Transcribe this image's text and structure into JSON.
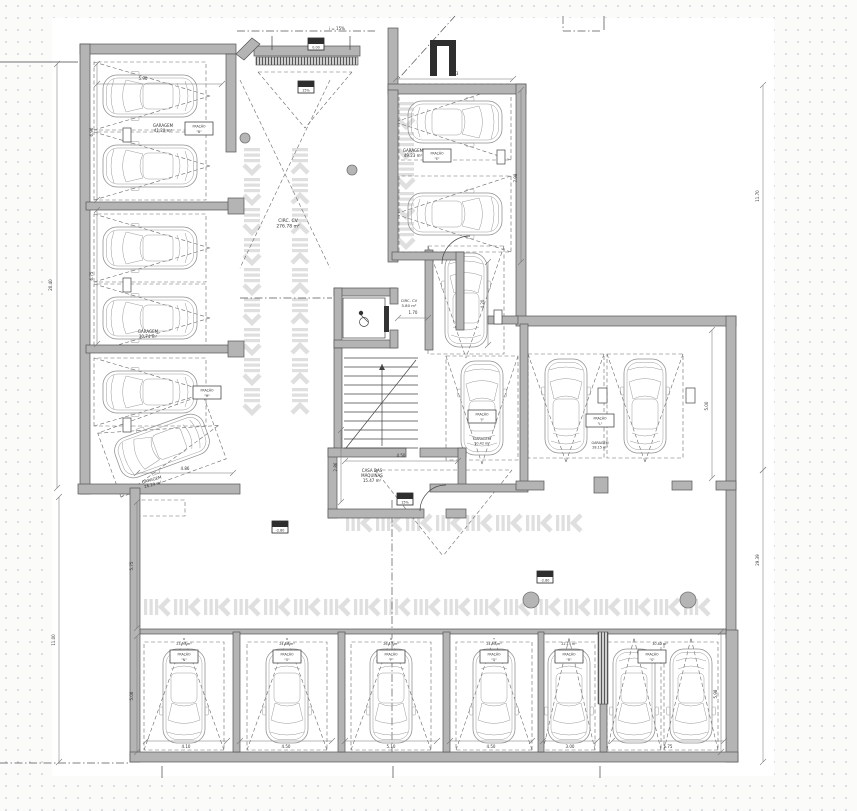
{
  "colors": {
    "paper": "#ffffff",
    "wall": "#b4b4b4",
    "wall_stroke": "#555555",
    "line": "#444444",
    "dash": "#6a6a6a",
    "car": "#8f8f8f",
    "chevron": "#dfdfdf",
    "dark": "#2e2e2e",
    "dot": "#d0d4db"
  },
  "paper": [
    52,
    18,
    722,
    758
  ],
  "labels": [
    {
      "lines": [
        "GARAGEM",
        "41.20 m²"
      ],
      "x": 163,
      "y": 127,
      "s": 4,
      "r": 0
    },
    {
      "lines": [
        "GARAGEM",
        "30.74 m²"
      ],
      "x": 148,
      "y": 333,
      "s": 4,
      "r": 0
    },
    {
      "lines": [
        "GARAGEM",
        "26.29 m²"
      ],
      "x": 152,
      "y": 481,
      "s": 4,
      "r": -15
    },
    {
      "lines": [
        "GARAGEM",
        "49.23 m²"
      ],
      "x": 413,
      "y": 152,
      "s": 4,
      "r": 0
    },
    {
      "lines": [
        "CIRC. CV",
        "276.78 m²"
      ],
      "x": 288,
      "y": 222,
      "s": 4.5,
      "r": 0
    },
    {
      "lines": [
        "CIRC. CV",
        "5.80 m²"
      ],
      "x": 409,
      "y": 302,
      "s": 3.8,
      "r": 0
    },
    {
      "lines": [
        "CASA DAS",
        "MÁQUINAS",
        "15.47 m²"
      ],
      "x": 372,
      "y": 472,
      "s": 4,
      "r": 0
    },
    {
      "lines": [
        "i = 15%"
      ],
      "x": 337,
      "y": 30,
      "s": 4,
      "r": 0
    },
    {
      "lines": [
        "23.95 m²"
      ],
      "x": 184,
      "y": 645,
      "s": 3.4,
      "r": 0
    },
    {
      "lines": [
        "24.86 m²"
      ],
      "x": 287,
      "y": 645,
      "s": 3.4,
      "r": 0
    },
    {
      "lines": [
        "26.15 m²"
      ],
      "x": 391,
      "y": 645,
      "s": 3.4,
      "r": 0
    },
    {
      "lines": [
        "24.90 m²"
      ],
      "x": 494,
      "y": 645,
      "s": 3.4,
      "r": 0
    },
    {
      "lines": [
        "22.15 m²"
      ],
      "x": 569,
      "y": 645,
      "s": 3.4,
      "r": 0
    },
    {
      "lines": [
        "30.82 m²"
      ],
      "x": 660,
      "y": 645,
      "s": 3.4,
      "r": 0
    },
    {
      "lines": [
        "GARAGEM",
        "10.42 m²"
      ],
      "x": 482,
      "y": 440,
      "s": 3.4,
      "r": 0
    },
    {
      "lines": [
        "GARAGEM",
        "28.15 m²"
      ],
      "x": 600,
      "y": 444,
      "s": 3.4,
      "r": 0
    }
  ],
  "fracao_tags": [
    {
      "x": 199,
      "y": 122,
      "t": "FRAÇÃO",
      "l": "\"B\""
    },
    {
      "x": 207,
      "y": 386,
      "t": "FRAÇÃO",
      "l": "\"M\""
    },
    {
      "x": 437,
      "y": 149,
      "t": "FRAÇÃO",
      "l": "\"E\""
    },
    {
      "x": 482,
      "y": 410,
      "t": "FRAÇÃO",
      "l": "\"J\""
    },
    {
      "x": 600,
      "y": 414,
      "t": "FRAÇÃO",
      "l": "\"L\""
    },
    {
      "x": 184,
      "y": 650,
      "t": "FRAÇÃO",
      "l": "\"N\""
    },
    {
      "x": 287,
      "y": 650,
      "t": "FRAÇÃO",
      "l": "\"O\""
    },
    {
      "x": 391,
      "y": 650,
      "t": "FRAÇÃO",
      "l": "\"P\""
    },
    {
      "x": 494,
      "y": 650,
      "t": "FRAÇÃO",
      "l": "\"Q\""
    },
    {
      "x": 569,
      "y": 650,
      "t": "FRAÇÃO",
      "l": "\"R\""
    },
    {
      "x": 652,
      "y": 650,
      "t": "FRAÇÃO",
      "l": "\"S\""
    }
  ],
  "level_markers": [
    {
      "x": 316,
      "y": 44,
      "text": "0.00"
    },
    {
      "x": 306,
      "y": 87,
      "text": "15%"
    },
    {
      "x": 405,
      "y": 499,
      "text": "15%"
    },
    {
      "x": 280,
      "y": 527,
      "text": "-2.80"
    },
    {
      "x": 545,
      "y": 577,
      "text": "-2.80"
    }
  ],
  "dimensions": [
    [
      57,
      64,
      57,
      488,
      "20.40",
      52,
      285,
      -90
    ],
    [
      59,
      497,
      59,
      762,
      "11.00",
      55,
      640,
      -90
    ],
    [
      137,
      502,
      137,
      628,
      "5.75",
      133,
      566,
      -90
    ],
    [
      137,
      636,
      137,
      752,
      "5.06",
      133,
      696,
      -90
    ],
    [
      763,
      85,
      763,
      470,
      "11.70",
      759,
      196,
      -90
    ],
    [
      763,
      470,
      763,
      762,
      "29.39",
      759,
      560,
      -90
    ],
    [
      396,
      79,
      513,
      79,
      "6.33",
      454,
      75,
      0
    ],
    [
      521,
      90,
      521,
      262,
      "7.98",
      517,
      178,
      -90
    ],
    [
      712,
      330,
      712,
      478,
      "5.00",
      708,
      406,
      -90
    ],
    [
      721,
      632,
      721,
      752,
      "5.98",
      717,
      694,
      -90
    ],
    [
      146,
      741,
      227,
      741,
      "4.10",
      186,
      748,
      0
    ],
    [
      240,
      741,
      332,
      741,
      "4.50",
      286,
      748,
      0
    ],
    [
      345,
      741,
      437,
      741,
      "5.10",
      391,
      748,
      0
    ],
    [
      450,
      741,
      532,
      741,
      "4.50",
      491,
      748,
      0
    ],
    [
      543,
      741,
      597,
      741,
      "3.00",
      570,
      748,
      0
    ],
    [
      612,
      741,
      724,
      741,
      "5.75",
      668,
      748,
      0
    ],
    [
      345,
      461,
      458,
      461,
      "4.50",
      401,
      457,
      0
    ],
    [
      341,
      430,
      341,
      502,
      "2.86",
      337,
      467,
      -90
    ],
    [
      137,
      473,
      233,
      473,
      "4.86",
      185,
      470,
      0
    ],
    [
      97,
      64,
      97,
      200,
      "6.96",
      93,
      132,
      -90
    ],
    [
      97,
      210,
      97,
      344,
      "6.75",
      93,
      276,
      -90
    ],
    [
      97,
      84,
      222,
      84,
      "5.90",
      143,
      80,
      0
    ],
    [
      488,
      262,
      488,
      345,
      "4.20",
      484,
      304,
      -90
    ],
    [
      398,
      318,
      428,
      318,
      "1.70",
      413,
      314,
      0
    ]
  ],
  "cars": [
    [
      150,
      96,
      -90,
      34,
      56
    ],
    [
      150,
      166,
      -90,
      34,
      56
    ],
    [
      150,
      248,
      -90,
      34,
      56
    ],
    [
      150,
      318,
      -90,
      34,
      56
    ],
    [
      150,
      392,
      -90,
      34,
      56
    ],
    [
      162,
      446,
      -110,
      34,
      56
    ],
    [
      455,
      122,
      90,
      38,
      56
    ],
    [
      455,
      214,
      90,
      38,
      56
    ],
    [
      466,
      300,
      0,
      38,
      54
    ],
    [
      482,
      408,
      0,
      36,
      52
    ],
    [
      566,
      406,
      0,
      38,
      52
    ],
    [
      645,
      406,
      0,
      38,
      52
    ],
    [
      184,
      696,
      180,
      40,
      54
    ],
    [
      287,
      696,
      180,
      40,
      54
    ],
    [
      391,
      696,
      180,
      40,
      54
    ],
    [
      494,
      696,
      180,
      38,
      54
    ],
    [
      569,
      696,
      180,
      26,
      54
    ],
    [
      634,
      696,
      180,
      27,
      54
    ],
    [
      691,
      696,
      180,
      27,
      54
    ]
  ],
  "walls": [
    [
      80,
      44,
      156,
      10
    ],
    [
      80,
      44,
      10,
      450
    ],
    [
      78,
      484,
      162,
      10
    ],
    [
      226,
      54,
      10,
      98
    ],
    [
      86,
      202,
      146,
      8
    ],
    [
      228,
      198,
      16,
      16
    ],
    [
      86,
      345,
      146,
      8
    ],
    [
      228,
      341,
      16,
      16
    ],
    [
      254,
      46,
      106,
      10
    ],
    [
      388,
      28,
      10,
      62
    ],
    [
      388,
      84,
      138,
      10
    ],
    [
      388,
      90,
      10,
      172
    ],
    [
      516,
      84,
      10,
      240
    ],
    [
      516,
      316,
      220,
      10
    ],
    [
      726,
      316,
      10,
      322
    ],
    [
      726,
      630,
      12,
      132
    ],
    [
      130,
      488,
      10,
      274
    ],
    [
      130,
      752,
      608,
      10
    ],
    [
      140,
      629,
      586,
      5
    ],
    [
      233,
      632,
      7,
      120
    ],
    [
      338,
      632,
      7,
      120
    ],
    [
      443,
      632,
      7,
      120
    ],
    [
      538,
      632,
      6,
      120
    ],
    [
      600,
      704,
      7,
      48
    ],
    [
      334,
      288,
      62,
      8
    ],
    [
      334,
      288,
      8,
      60
    ],
    [
      334,
      340,
      62,
      8
    ],
    [
      390,
      288,
      8,
      16
    ],
    [
      390,
      330,
      8,
      18
    ],
    [
      334,
      348,
      8,
      106
    ],
    [
      425,
      250,
      8,
      100
    ],
    [
      328,
      448,
      9,
      70
    ],
    [
      328,
      448,
      78,
      9
    ],
    [
      420,
      448,
      46,
      9
    ],
    [
      458,
      448,
      8,
      40
    ],
    [
      328,
      509,
      96,
      9
    ],
    [
      446,
      509,
      20,
      9
    ],
    [
      520,
      324,
      8,
      166
    ],
    [
      430,
      484,
      98,
      8
    ],
    [
      516,
      481,
      28,
      9
    ],
    [
      594,
      477,
      14,
      16
    ],
    [
      672,
      481,
      20,
      9
    ],
    [
      716,
      481,
      20,
      9
    ],
    [
      392,
      252,
      72,
      8
    ],
    [
      456,
      252,
      8,
      78
    ],
    [
      488,
      316,
      30,
      8
    ]
  ],
  "wall_polys": [
    [
      [
        236,
        54
      ],
      [
        252,
        38
      ],
      [
        260,
        44
      ],
      [
        244,
        60
      ]
    ]
  ],
  "hatch_strips": [
    [
      256,
      57,
      102,
      8
    ],
    [
      598,
      632,
      10,
      72
    ]
  ],
  "dark_rects": [
    [
      430,
      40,
      7,
      36
    ],
    [
      449,
      40,
      7,
      36
    ],
    [
      430,
      40,
      26,
      6
    ]
  ],
  "columns": [
    [
      123,
      128,
      8,
      14
    ],
    [
      123,
      278,
      8,
      14
    ],
    [
      123,
      418,
      8,
      14
    ],
    [
      497,
      150,
      8,
      14
    ],
    [
      494,
      310,
      8,
      14
    ],
    [
      598,
      388,
      9,
      15
    ],
    [
      686,
      388,
      9,
      15
    ]
  ],
  "circles": [
    [
      245,
      138,
      5
    ],
    [
      352,
      170,
      5
    ],
    [
      531,
      600,
      8
    ],
    [
      688,
      600,
      8
    ]
  ],
  "dash_lines": [
    [
      258,
      72,
      352,
      72
    ],
    [
      258,
      72,
      305,
      128
    ],
    [
      352,
      72,
      305,
      128
    ],
    [
      240,
      80,
      330,
      268
    ],
    [
      330,
      80,
      240,
      268
    ],
    [
      375,
      470,
      512,
      470
    ],
    [
      375,
      470,
      443,
      556
    ],
    [
      512,
      470,
      443,
      556
    ]
  ],
  "dash_rects": [
    [
      135,
      500,
      50,
      16
    ]
  ],
  "dashdot_lines": [
    [
      237,
      31,
      375,
      31
    ],
    [
      392,
      86,
      455,
      16
    ],
    [
      563,
      16,
      563,
      31
    ],
    [
      563,
      31,
      600,
      31
    ],
    [
      0,
      763,
      130,
      763
    ],
    [
      392,
      500,
      392,
      762
    ],
    [
      240,
      298,
      332,
      298
    ]
  ],
  "solid_lines": [
    [
      0,
      62,
      78,
      62
    ]
  ],
  "ticks": [
    [
      272,
      36,
      272,
      50
    ],
    [
      350,
      36,
      350,
      50
    ],
    [
      604,
      16,
      604,
      30
    ],
    [
      162,
      766,
      162,
      778
    ],
    [
      393,
      766,
      393,
      778
    ],
    [
      600,
      766,
      600,
      778
    ]
  ],
  "arcs": [
    "M 420 511 A 26 26 0 0 1 446 485",
    "M 470 236 A 28 28 0 0 0 442 264"
  ],
  "chevron_lanes": [
    {
      "o": "v",
      "x": 252,
      "a": 148,
      "b": 438,
      "d": 1
    },
    {
      "o": "v",
      "x": 300,
      "a": 148,
      "b": 442,
      "d": -1
    },
    {
      "o": "v",
      "x": 406,
      "a": 102,
      "b": 248,
      "d": 1
    },
    {
      "o": "h",
      "y": 523,
      "a": 346,
      "b": 602,
      "d": -1
    },
    {
      "o": "h",
      "y": 607,
      "a": 144,
      "b": 722,
      "d": -1
    }
  ],
  "stairs": {
    "x1": 344,
    "x2": 418,
    "y1": 358,
    "y2": 448,
    "step": 9,
    "brk": [
      346,
      448,
      416,
      360
    ],
    "arrow": [
      382,
      446,
      382,
      364
    ]
  },
  "elevator": {
    "cab": [
      343,
      298,
      42,
      40
    ],
    "door": [
      384,
      306,
      5,
      26
    ],
    "px": 361,
    "py": 313,
    "wx": 364,
    "wy": 322
  }
}
